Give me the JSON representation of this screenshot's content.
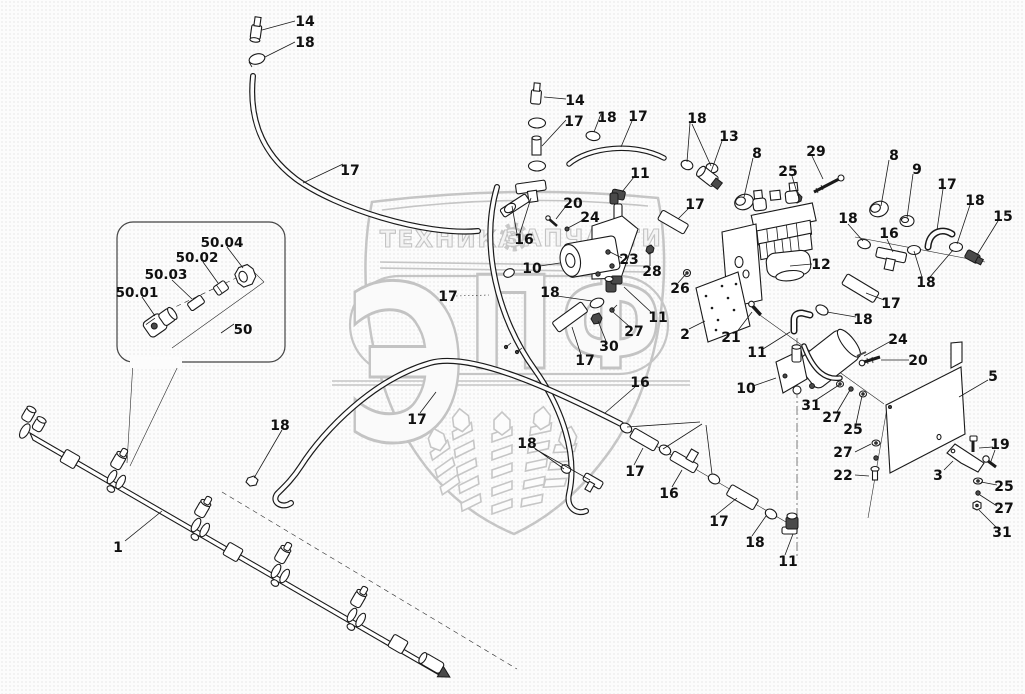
{
  "watermark": {
    "brand_letter_big": "Э",
    "brand_letters_small": "ПФ",
    "banner_left": "ТЕХНИКА",
    "banner_right": "ЗАПЧАСТИ",
    "color": "#c5c5c5"
  },
  "diagram": {
    "kind": "exploded-parts-diagram",
    "part_labels": [
      {
        "t": "14",
        "x": 305,
        "y": 21
      },
      {
        "t": "18",
        "x": 305,
        "y": 42
      },
      {
        "t": "17",
        "x": 350,
        "y": 170
      },
      {
        "t": "14",
        "x": 575,
        "y": 100
      },
      {
        "t": "17",
        "x": 574,
        "y": 121
      },
      {
        "t": "18",
        "x": 607,
        "y": 117
      },
      {
        "t": "17",
        "x": 638,
        "y": 116
      },
      {
        "t": "18",
        "x": 697,
        "y": 118
      },
      {
        "t": "13",
        "x": 729,
        "y": 136
      },
      {
        "t": "8",
        "x": 757,
        "y": 153
      },
      {
        "t": "29",
        "x": 816,
        "y": 151
      },
      {
        "t": "25",
        "x": 788,
        "y": 171
      },
      {
        "t": "8",
        "x": 894,
        "y": 155
      },
      {
        "t": "9",
        "x": 917,
        "y": 169
      },
      {
        "t": "17",
        "x": 947,
        "y": 184
      },
      {
        "t": "18",
        "x": 975,
        "y": 200
      },
      {
        "t": "15",
        "x": 1003,
        "y": 216
      },
      {
        "t": "11",
        "x": 640,
        "y": 173
      },
      {
        "t": "17",
        "x": 695,
        "y": 204
      },
      {
        "t": "20",
        "x": 573,
        "y": 203
      },
      {
        "t": "24",
        "x": 590,
        "y": 217
      },
      {
        "t": "16",
        "x": 524,
        "y": 239
      },
      {
        "t": "10",
        "x": 532,
        "y": 268
      },
      {
        "t": "23",
        "x": 629,
        "y": 259
      },
      {
        "t": "28",
        "x": 652,
        "y": 271
      },
      {
        "t": "26",
        "x": 680,
        "y": 288
      },
      {
        "t": "12",
        "x": 821,
        "y": 264
      },
      {
        "t": "18",
        "x": 848,
        "y": 218
      },
      {
        "t": "16",
        "x": 889,
        "y": 233
      },
      {
        "t": "18",
        "x": 926,
        "y": 282
      },
      {
        "t": "17",
        "x": 891,
        "y": 303
      },
      {
        "t": "18",
        "x": 863,
        "y": 319
      },
      {
        "t": "24",
        "x": 898,
        "y": 339
      },
      {
        "t": "18",
        "x": 550,
        "y": 292
      },
      {
        "t": "17",
        "x": 448,
        "y": 296
      },
      {
        "t": "27",
        "x": 634,
        "y": 331
      },
      {
        "t": "30",
        "x": 609,
        "y": 346
      },
      {
        "t": "11",
        "x": 658,
        "y": 317
      },
      {
        "t": "2",
        "x": 685,
        "y": 334
      },
      {
        "t": "21",
        "x": 731,
        "y": 337
      },
      {
        "t": "17",
        "x": 585,
        "y": 360
      },
      {
        "t": "16",
        "x": 640,
        "y": 382
      },
      {
        "t": "17",
        "x": 417,
        "y": 419
      },
      {
        "t": "18",
        "x": 527,
        "y": 443
      },
      {
        "t": "18",
        "x": 280,
        "y": 425
      },
      {
        "t": "1",
        "x": 118,
        "y": 547
      },
      {
        "t": "17",
        "x": 635,
        "y": 471
      },
      {
        "t": "16",
        "x": 669,
        "y": 493
      },
      {
        "t": "17",
        "x": 719,
        "y": 521
      },
      {
        "t": "18",
        "x": 755,
        "y": 542
      },
      {
        "t": "11",
        "x": 788,
        "y": 561
      },
      {
        "t": "11",
        "x": 757,
        "y": 352
      },
      {
        "t": "10",
        "x": 746,
        "y": 388
      },
      {
        "t": "31",
        "x": 811,
        "y": 405
      },
      {
        "t": "27",
        "x": 832,
        "y": 417
      },
      {
        "t": "25",
        "x": 853,
        "y": 429
      },
      {
        "t": "27",
        "x": 843,
        "y": 452
      },
      {
        "t": "22",
        "x": 843,
        "y": 475
      },
      {
        "t": "20",
        "x": 918,
        "y": 360
      },
      {
        "t": "5",
        "x": 993,
        "y": 376
      },
      {
        "t": "3",
        "x": 938,
        "y": 475
      },
      {
        "t": "19",
        "x": 1000,
        "y": 444
      },
      {
        "t": "25",
        "x": 1004,
        "y": 486
      },
      {
        "t": "27",
        "x": 1004,
        "y": 508
      },
      {
        "t": "31",
        "x": 1002,
        "y": 532
      }
    ],
    "inset_labels": [
      {
        "t": "50.04",
        "x": 222,
        "y": 242
      },
      {
        "t": "50.02",
        "x": 197,
        "y": 257
      },
      {
        "t": "50.03",
        "x": 166,
        "y": 274
      },
      {
        "t": "50.01",
        "x": 137,
        "y": 292
      },
      {
        "t": "50",
        "x": 243,
        "y": 329
      }
    ]
  }
}
